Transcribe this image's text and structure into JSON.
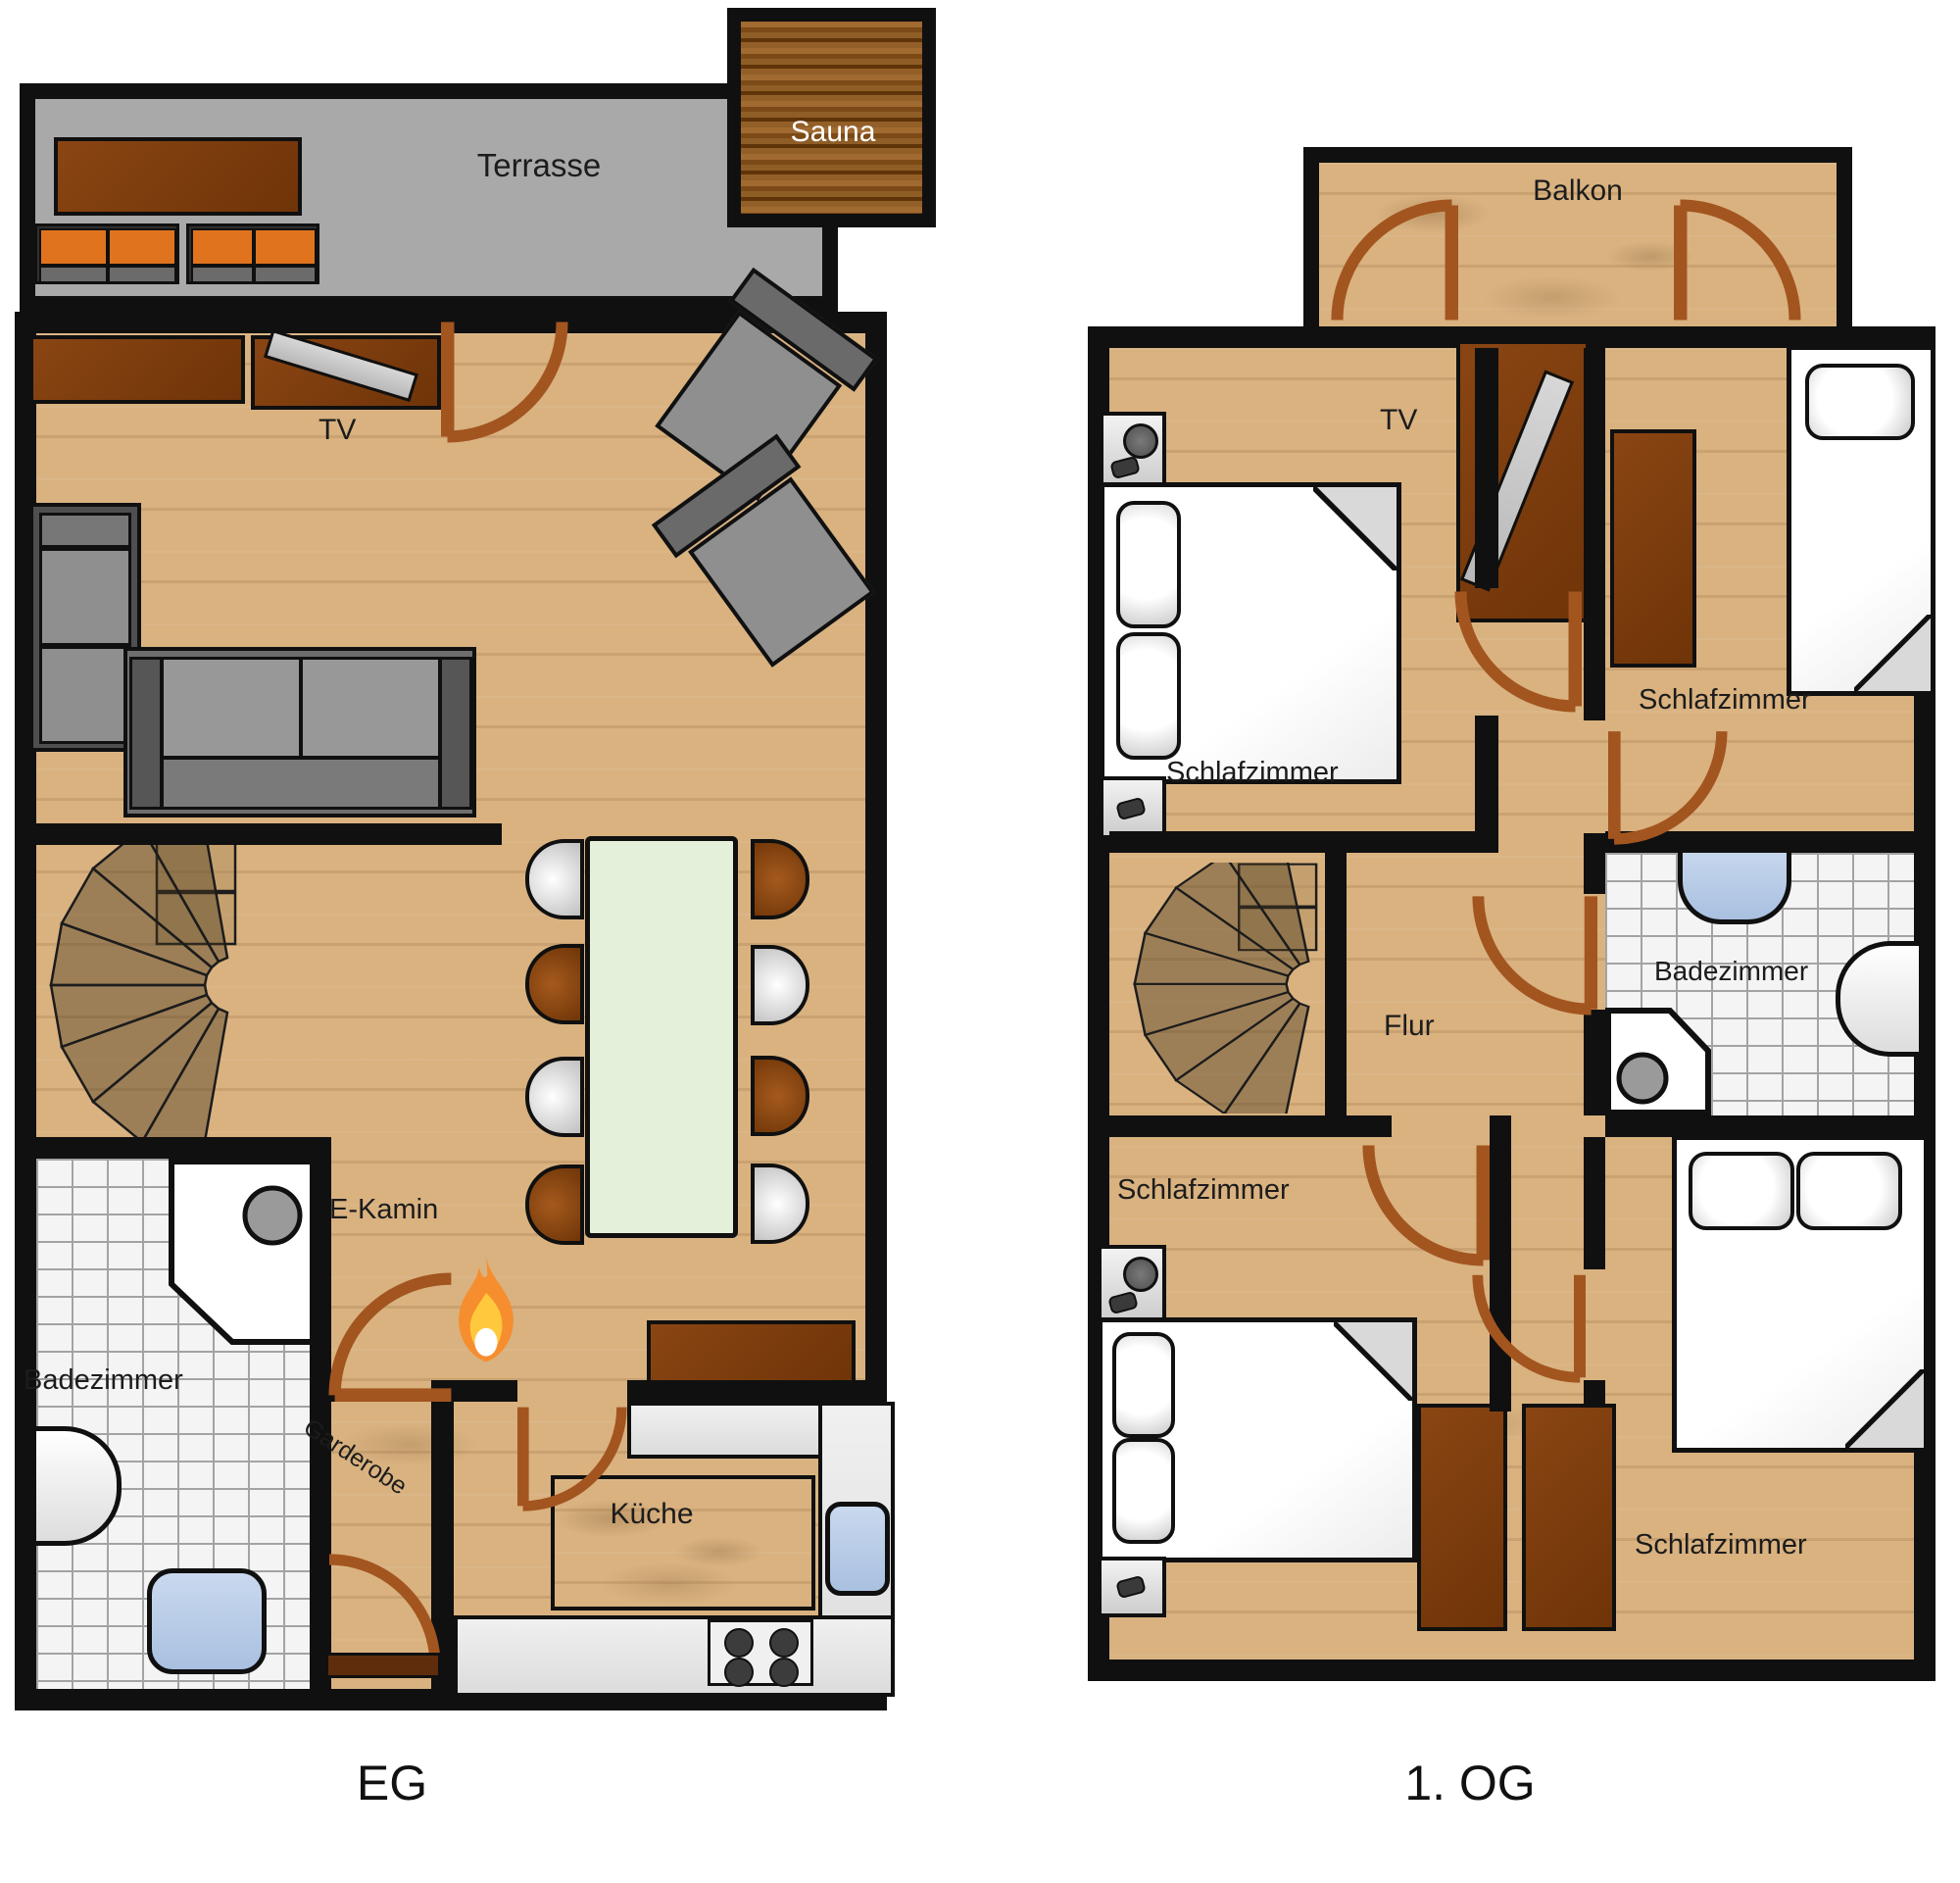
{
  "meta": {
    "type": "floorplan",
    "language": "de"
  },
  "floors": [
    {
      "id": "eg",
      "floor_label": "EG",
      "rooms": {
        "terrasse": "Terrasse",
        "sauna": "Sauna",
        "tv": "TV",
        "ekamin": "E-Kamin",
        "badezimmer": "Badezimmer",
        "garderobe": "Garderobe",
        "kueche": "Küche"
      }
    },
    {
      "id": "og1",
      "floor_label": "1. OG",
      "rooms": {
        "balkon": "Balkon",
        "tv": "TV",
        "schlafzimmer_nw": "Schlafzimmer",
        "schlafzimmer_ne": "Schlafzimmer",
        "badezimmer": "Badezimmer",
        "flur": "Flur",
        "schlafzimmer_sw": "Schlafzimmer",
        "schlafzimmer_se": "Schlafzimmer"
      }
    }
  ],
  "colors": {
    "wall": "#101010",
    "wood_floor": "#d9b280",
    "terrace_gray": "#a9a9a9",
    "door_brown": "#a3551f",
    "furniture_orange": "#e0741e",
    "furniture_brown": "#7d3b0e",
    "sofa_gray": "#8a8a8a",
    "dining_table_green": "#e4f0da",
    "tile_white": "#f4f4f4",
    "water_blue": "#b9cde8",
    "fire_orange": "#f68d2e"
  },
  "icons": {
    "fire": "fire-icon",
    "door": "door-swing-icon",
    "stairs": "spiral-stairs-icon"
  }
}
